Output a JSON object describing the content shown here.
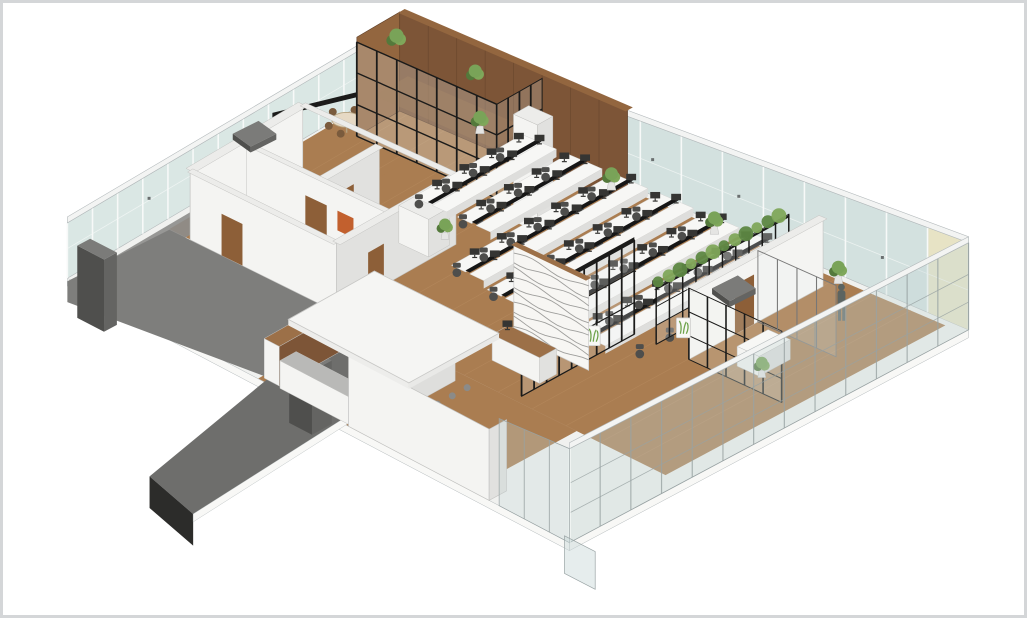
{
  "view": {
    "projection": "axonometric",
    "subject": "office floor interior cutaway render",
    "text_content": "none"
  },
  "palette": {
    "background": "#ffffff",
    "border": "#d4d6d8",
    "floor_base": "#f0f1ef",
    "slab_edge": "#f8f8f6",
    "edge_line": "#b3b9bb",
    "glass_back_left": "#dae7e4",
    "glass_back_right": "#d3e1df",
    "glass_front": "#c7d6d8",
    "mullion": "#f7f9f8",
    "frame_gray": "#98a2a3",
    "fascia": "#f3f4f3",
    "cream_wall": "#ece8d4",
    "cream_corner": "#e9e3c2",
    "wall_lit": "#f4f4f2",
    "wall_shade": "#e1e1df",
    "wall_top": "#ececea",
    "wall_line": "#c2c2c0",
    "interior_floor": "#ededeb",
    "corridor_floor": "#8b8b89",
    "wood_floor": "#aa7d51",
    "wood_light": "#bb9064",
    "wood_dark": "#8a6743",
    "wood_cap": "#9c7048",
    "timber_wall": "#7d5537",
    "timber_side": "#93663f",
    "timber_seam": "#5f3f28",
    "door_brown": "#8d5f38",
    "black_frame": "#1b1b1a",
    "terrace": "#7e7e7c",
    "walkway": "#8d8d8b",
    "corridor": "#6e6e6c",
    "corridor_dark": "#2c2c2a",
    "duct_front": "#4f4f4d",
    "duct_side": "#646462",
    "duct_top": "#7b7b79",
    "desk_top": "#f7f7f5",
    "desk_edge": "#dededc",
    "spine_black": "#161616",
    "monitor": "#353533",
    "chair": "#4e4e4c",
    "hedge": "#7fa75a",
    "hedge_dark": "#5d8742",
    "plant": "#79a358",
    "plant_dark": "#54793b",
    "pot": "#e5e5e3",
    "table_wood": "#e6d9c4",
    "table_wood_edge": "#b5a27f",
    "chair_wood": "#7a5b3d",
    "counter_gray": "#b9b9b7",
    "orange_accent": "#c2602e",
    "wave_line": "#8e8e8c",
    "sign_green": "#6fa34c",
    "person": "#5c6461",
    "sensor": "#6a6f70"
  },
  "scene": {
    "regions": [
      {
        "id": "floor-slab",
        "label": "Floor slab with timber flooring"
      },
      {
        "id": "curtain-wall-back-left",
        "label": "Glazed curtain wall, back-left elevation"
      },
      {
        "id": "curtain-wall-back-right",
        "label": "Glazed curtain wall, back-right elevation"
      },
      {
        "id": "rooftop-unit",
        "label": "Rooftop plant unit at far corner"
      },
      {
        "id": "terrace-corridor",
        "label": "Grey roof terrace with exit bridge and duct units"
      },
      {
        "id": "dining-area",
        "label": "Dining table with chairs by the window"
      },
      {
        "id": "timber-meeting-suite",
        "label": "Timber-clad meeting suite with black-framed glazing"
      },
      {
        "id": "service-core",
        "label": "Service core with small rooms and timber doors"
      },
      {
        "id": "open-plan-workstations",
        "label": "Open-plan workstation rows with monitors and task chairs"
      },
      {
        "id": "black-partition",
        "label": "Black steel-framed glass partition"
      },
      {
        "id": "planter-partition",
        "label": "Glass partition topped with planter hedge"
      },
      {
        "id": "reception",
        "label": "Reception desk and carved feature wall"
      },
      {
        "id": "cafeteria",
        "label": "Cafeteria with long table and white canopy"
      },
      {
        "id": "front-meeting-rooms",
        "label": "Front meeting rooms with occupant and plants"
      },
      {
        "id": "front-facade",
        "label": "Full-height glazed front facade"
      }
    ],
    "counts": {
      "workstation_rows": 6,
      "visible_people": 1,
      "potted_plants": 10
    }
  }
}
